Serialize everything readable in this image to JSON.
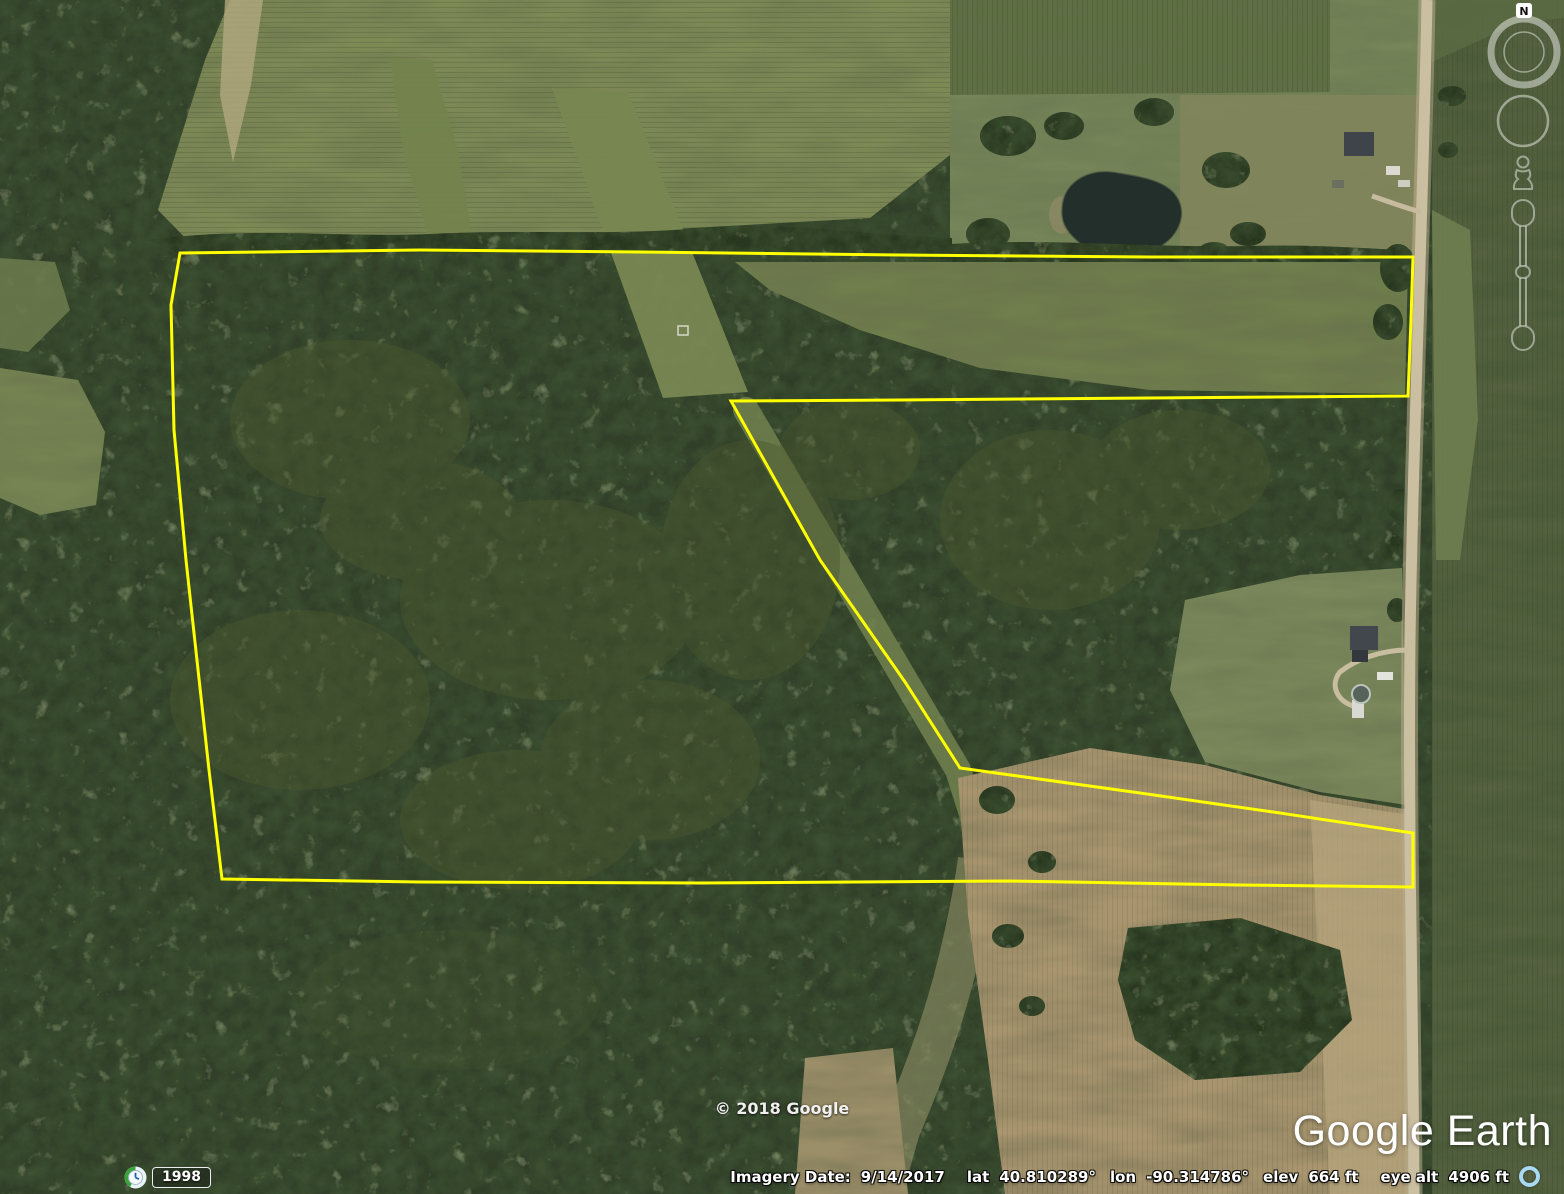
{
  "app": {
    "name": "Google Earth"
  },
  "map_overlay": {
    "parcel_outline": {
      "color": "#ffff00",
      "points": "180,253 420,250 640,252 900,255 1150,257 1413,257 1411,320 1408,396 1150,398 900,400 731,401 820,560 905,682 960,768 1140,793 1280,813 1413,833 1413,887 1240,885 1010,881 700,883 420,882 222,879 209,770 186,560 174,430 171,305"
    },
    "copyright": "© 2018 Google",
    "watermark": "Google Earth"
  },
  "navigation_controls": {
    "north_label": "N"
  },
  "time_control": {
    "year": "1998"
  },
  "status_bar": {
    "imagery_date_label": "Imagery Date:",
    "imagery_date": "9/14/2017",
    "lat_label": "lat",
    "lat_value": "40.810289°",
    "lon_label": "lon",
    "lon_value": "-90.314786°",
    "elev_label": "elev",
    "elev_value": "664 ft",
    "eye_alt_label": "eye alt",
    "eye_alt_value": "4906 ft"
  },
  "colors": {
    "parcel_outline": "#ffff00",
    "status_text": "#ffffff",
    "watermark_text": "#ffffff",
    "road": "#cbbfa2",
    "forest_green": "#33402a",
    "field_green": "#7e8a57",
    "field_tan": "#a99570",
    "streaming_ring": "#a8d8f2"
  }
}
